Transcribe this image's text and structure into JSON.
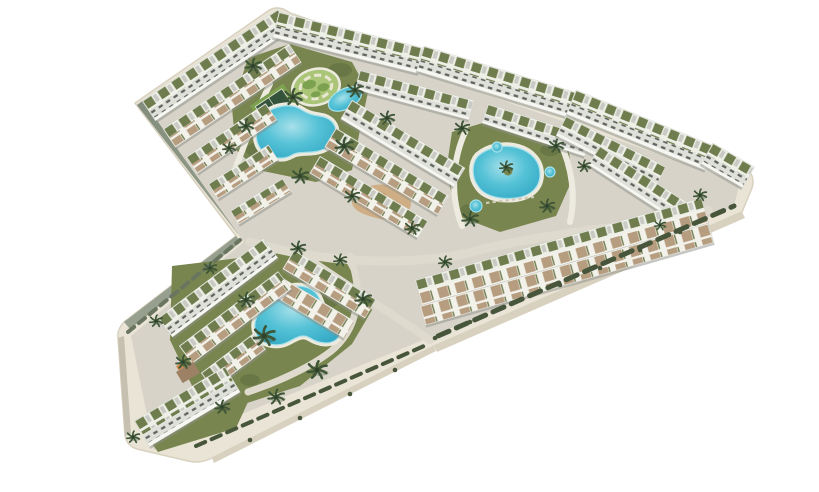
{
  "scene": {
    "type": "aerial-architectural-rendering",
    "description": "Bird's-eye 3D render of a chevron-shaped residential resort complex: white low-rise apartment blocks and townhouses with olive-green roof gardens and tan terraces on a cream podium, three turquoise lagoon-style pools, a teardrop pool with palm island, three round plunge pools, a circular ornamental garden, a paddle court, a playground and scattered palm trees, all on a plain white background",
    "background_is_blank_white": true,
    "visible_text": ""
  },
  "features": {
    "podium": "chevron / arrow-shaped raised platform with cream walkway edges",
    "main_courtyard": "lagoon pool, circular ornamental garden, paddle court",
    "east_courtyard": "teardrop pool with island palm and three round plunge pools",
    "south_wing_courtyard": "twin-lobe lagoon pool with overhanging palm",
    "playground": "tan winding-path play area with orange equipment",
    "buildings": "white residential rows with green roof gardens, gray penthouses, tan patios",
    "landscape": "lawns, hedges, palm trees, light gray internal roads"
  },
  "palette": {
    "bg": "#ffffff",
    "plinth_top": "#e9e4d6",
    "plinth_bevel": "#d8d1bf",
    "plinth_side_sage": "#828c7c",
    "plinth_side_sage2": "#97a08e",
    "plinth_west": "#c6c0b0",
    "ground": "#d7d3c8",
    "road": "#dedacd",
    "deck": "#edebdf",
    "lawn": "#78854e",
    "lawn_dark": "#5c6b3f",
    "hedge": "#47553b",
    "hedge_soft": "#6a7560",
    "building_white": "#f6f6f2",
    "building_grey": "#c9cac3",
    "win_base": "#dfe0da",
    "shadow": "#8e9088",
    "roof_bg": "#eef0e8",
    "roof_green": "#6f7d4e",
    "town_bg": "#f2f1ea",
    "terrace_tan": "#b79d80",
    "terrace_brown": "#9c8165",
    "window_dark": "#4a4f49",
    "pool_deep": "#2ea5c3",
    "pool_mid": "#55c2d6",
    "pool_pale": "#a7e0ea",
    "garden_base": "#aac578",
    "garden_blob": "#7ca24f",
    "garden_path": "#e9e6d2",
    "court_green": "#33543a",
    "play_tan": "#cfae85",
    "accent_orange": "#cf8a4e",
    "palm": "#3e5637",
    "palm_dark": "#2e4229",
    "lounger": "#cfc9b8"
  }
}
